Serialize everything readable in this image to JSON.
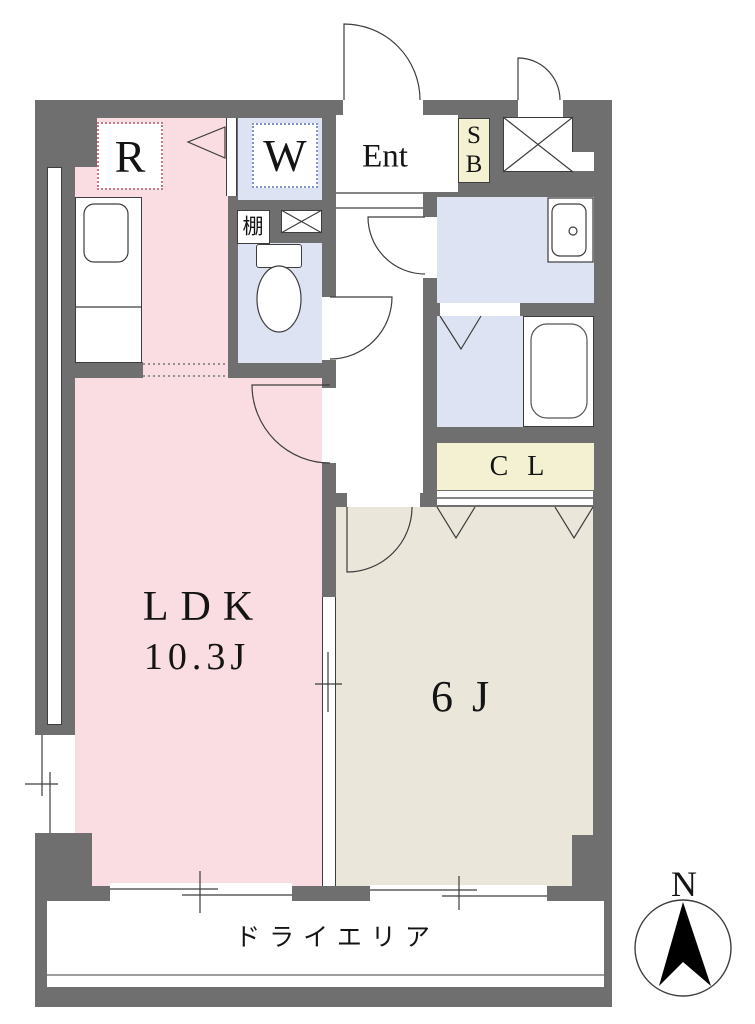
{
  "labels": {
    "refrigerator": "R",
    "washer": "W",
    "entrance": "Ent",
    "shoebox": [
      "S",
      "B"
    ],
    "shelf": "棚",
    "closet": "C L",
    "ldk_name": "LDK",
    "ldk_size": "10.3J",
    "bedroom_size": "6 J",
    "dry_area": "ドライエリア",
    "compass_north": "N"
  },
  "colors": {
    "wall": "#6f6f6f",
    "ldk_room": "#f9dde2",
    "wet_rooms": "#dde3f2",
    "bedroom_room": "#eae6da",
    "storage": "#f4f0d2",
    "refrigerator_dotted_border": "#d4737f",
    "washer_dotted_border": "#8096c8",
    "linework": "#3d3d3d"
  }
}
